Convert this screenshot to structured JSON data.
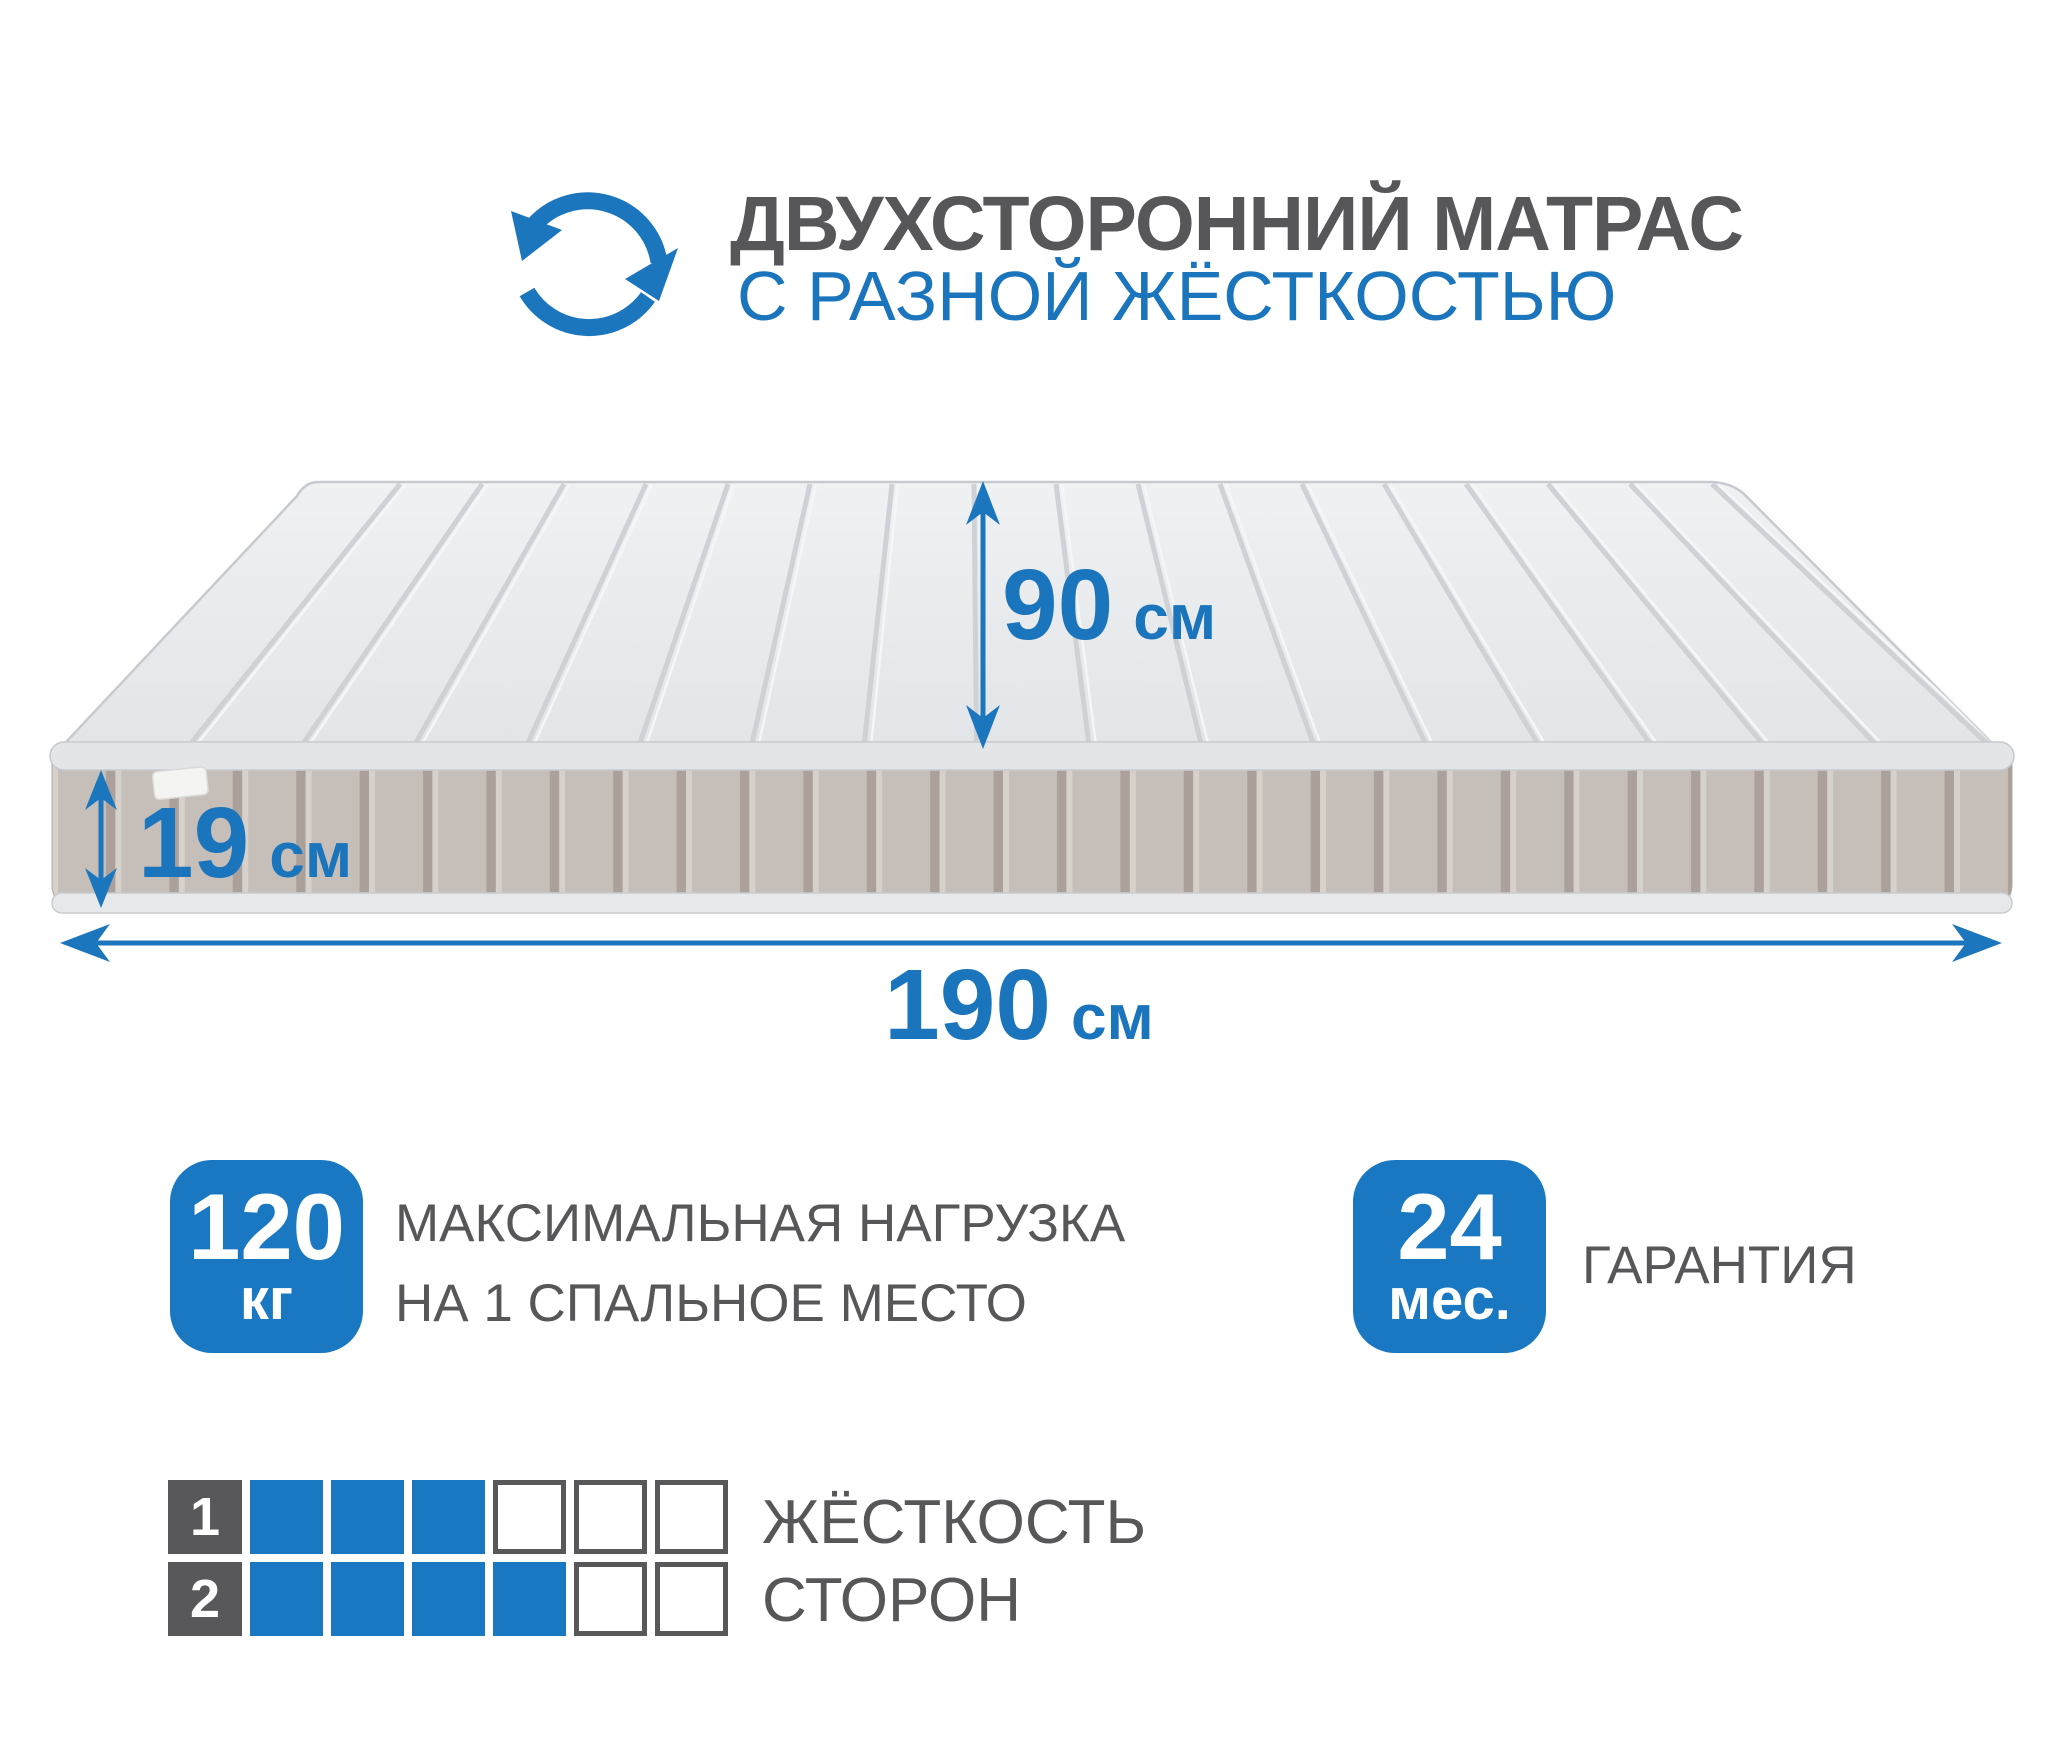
{
  "header": {
    "title": "ДВУХСТОРОННИЙ МАТРАС",
    "subtitle": "С РАЗНОЙ ЖЁСТКОСТЬЮ",
    "icon": "rotate-double-arrows-icon"
  },
  "dimensions": {
    "height": {
      "value": "90",
      "unit": "см"
    },
    "thickness": {
      "value": "19",
      "unit": "см"
    },
    "length": {
      "value": "190",
      "unit": "см"
    }
  },
  "badges": {
    "max_load": {
      "value": "120",
      "unit": "кг",
      "caption_lines": [
        "МАКСИМАЛЬНАЯ НАГРУЗКА",
        "НА 1 СПАЛЬНОЕ МЕСТО"
      ]
    },
    "warranty": {
      "value": "24",
      "unit": "мес.",
      "caption": "ГАРАНТИЯ"
    }
  },
  "firmness": {
    "label_line1": "ЖЁСТКОСТЬ",
    "label_line2": "СТОРОН",
    "scale_max": 6,
    "rows": [
      {
        "side": "1",
        "filled": 3
      },
      {
        "side": "2",
        "filled": 4
      }
    ]
  },
  "colors": {
    "accent_blue": "#1a78c2",
    "text_blue": "#1b75bc",
    "dark_gray": "#58585a",
    "mattress_top": "#e8ebed",
    "mattress_side": "#c6beb8"
  }
}
